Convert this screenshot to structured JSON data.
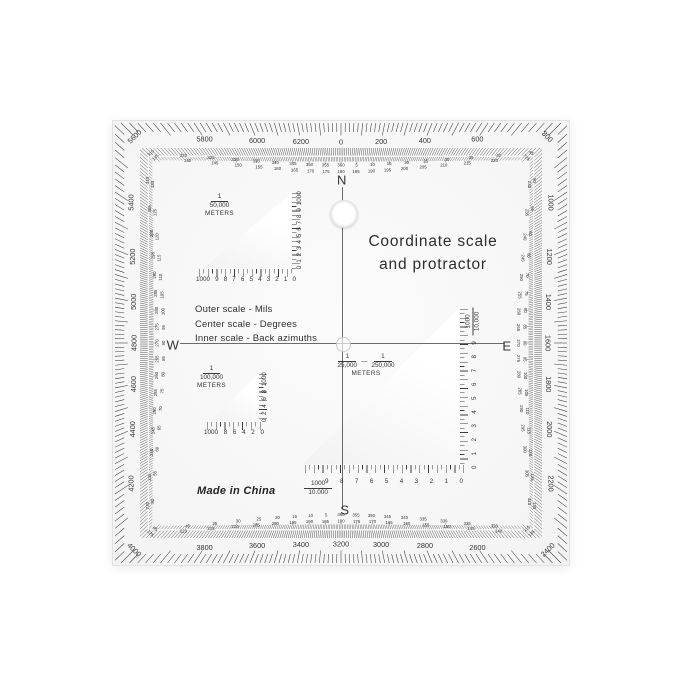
{
  "product": {
    "title_line1": "Coordinate scale",
    "title_line2": "and protractor",
    "made_in": "Made in China"
  },
  "legend": {
    "outer": "Outer scale - Mils",
    "center": "Center scale - Degrees",
    "inner": "Inner scale - Back azimuths"
  },
  "compass": {
    "n": "N",
    "e": "E",
    "s": "S",
    "w": "W"
  },
  "colors": {
    "ink": "#3a3a3a",
    "plastic": "#f7f7f7",
    "page": "#ffffff"
  },
  "outer_scale": {
    "name": "mils",
    "full_circle": 6400,
    "label_step": 200,
    "labels": [
      0,
      200,
      400,
      600,
      800,
      1000,
      1200,
      1400,
      1600,
      1800,
      2000,
      2200,
      2400,
      2600,
      2800,
      3000,
      3200,
      3400,
      3600,
      3800,
      4000,
      4200,
      4400,
      4600,
      4800,
      5000,
      5200,
      5400,
      5600,
      5800,
      6000,
      6200
    ]
  },
  "degree_scale": {
    "name": "degrees",
    "step": 5,
    "pairs": [
      [
        5,
        185
      ],
      [
        10,
        190
      ],
      [
        15,
        195
      ],
      [
        20,
        200
      ],
      [
        25,
        205
      ],
      [
        30,
        210
      ],
      [
        35,
        215
      ],
      [
        40,
        220
      ],
      [
        45,
        225
      ],
      [
        50,
        230
      ],
      [
        55,
        235
      ],
      [
        60,
        240
      ],
      [
        65,
        245
      ],
      [
        70,
        250
      ],
      [
        75,
        255
      ],
      [
        80,
        260
      ],
      [
        85,
        265
      ],
      [
        90,
        270
      ],
      [
        95,
        275
      ],
      [
        100,
        280
      ],
      [
        105,
        285
      ],
      [
        110,
        290
      ],
      [
        115,
        295
      ],
      [
        120,
        300
      ],
      [
        125,
        305
      ],
      [
        130,
        310
      ],
      [
        135,
        315
      ],
      [
        140,
        320
      ],
      [
        145,
        325
      ],
      [
        150,
        330
      ],
      [
        155,
        335
      ],
      [
        160,
        340
      ],
      [
        165,
        345
      ],
      [
        170,
        350
      ],
      [
        175,
        355
      ],
      [
        180,
        360
      ],
      [
        185,
        5
      ],
      [
        190,
        10
      ],
      [
        195,
        15
      ],
      [
        200,
        20
      ],
      [
        205,
        25
      ],
      [
        210,
        30
      ],
      [
        215,
        35
      ],
      [
        220,
        40
      ],
      [
        225,
        45
      ],
      [
        230,
        50
      ],
      [
        235,
        55
      ],
      [
        240,
        60
      ],
      [
        245,
        65
      ],
      [
        250,
        70
      ],
      [
        255,
        75
      ],
      [
        260,
        80
      ],
      [
        265,
        85
      ],
      [
        270,
        90
      ],
      [
        275,
        95
      ],
      [
        280,
        100
      ],
      [
        285,
        105
      ],
      [
        290,
        110
      ],
      [
        295,
        115
      ],
      [
        300,
        120
      ],
      [
        305,
        125
      ],
      [
        310,
        130
      ],
      [
        315,
        135
      ],
      [
        320,
        140
      ],
      [
        325,
        145
      ],
      [
        330,
        150
      ],
      [
        335,
        155
      ],
      [
        340,
        160
      ],
      [
        345,
        165
      ],
      [
        350,
        170
      ],
      [
        355,
        175
      ],
      [
        360,
        180
      ]
    ]
  },
  "scales": {
    "t50k": {
      "numerator": "1",
      "denominator": "50,000",
      "unit": "METERS",
      "bottom_numbers": [
        "1000",
        "9",
        "8",
        "7",
        "6",
        "5",
        "4",
        "3",
        "2",
        "1",
        "0"
      ],
      "side_numbers": [
        "0",
        "1",
        "2",
        "3",
        "4",
        "5",
        "6",
        "7",
        "8",
        "9",
        "1000"
      ]
    },
    "t100k": {
      "numerator": "1",
      "denominator": "100,000",
      "unit": "METERS",
      "bottom_numbers": [
        "1000",
        "8",
        "6",
        "4",
        "2",
        "0"
      ],
      "side_numbers": [
        "0",
        "2",
        "4",
        "6",
        "8",
        "1000"
      ]
    },
    "t25k": {
      "numerator1": "1",
      "denominator1": "25,000",
      "dash": "—",
      "numerator2": "1",
      "denominator2": "250,000",
      "unit": "METERS",
      "side_label_num": "1000",
      "side_label_den": "10,000",
      "bottom_label_num": "1000",
      "bottom_label_den": "10.000",
      "side_numbers": [
        "0",
        "1",
        "2",
        "3",
        "4",
        "5",
        "6",
        "7",
        "8",
        "9"
      ],
      "bottom_numbers": [
        "9",
        "8",
        "7",
        "6",
        "5",
        "4",
        "3",
        "2",
        "1",
        "0"
      ]
    }
  }
}
